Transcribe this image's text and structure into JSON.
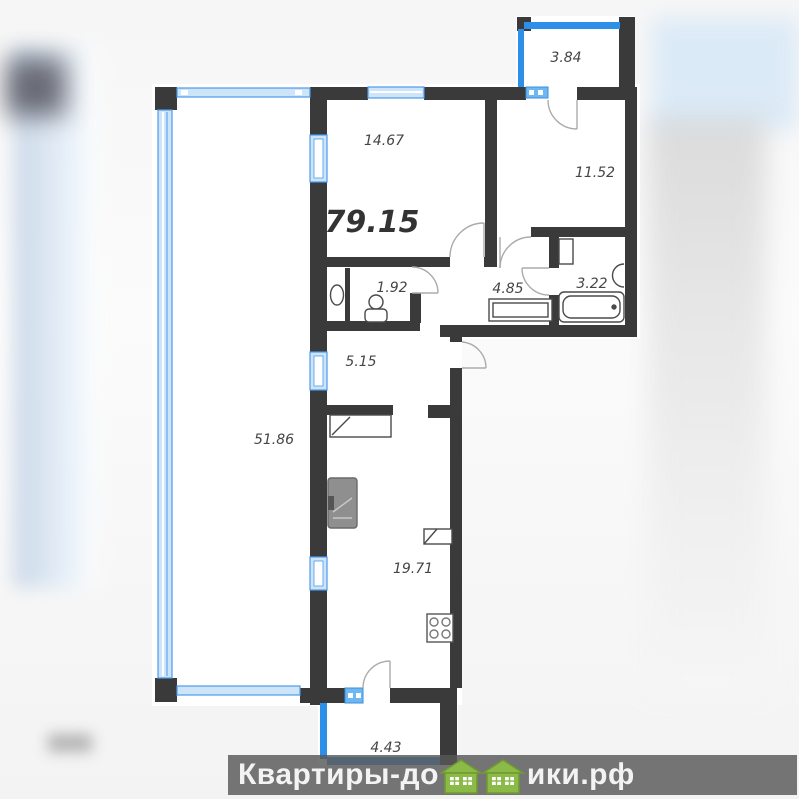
{
  "plan": {
    "total_area_label": "79.15",
    "rooms": [
      {
        "name": "balcony-top",
        "area": "3.84"
      },
      {
        "name": "living-room",
        "area": "14.67"
      },
      {
        "name": "bedroom",
        "area": "11.52"
      },
      {
        "name": "wc",
        "area": "1.92"
      },
      {
        "name": "hallway",
        "area": "4.85"
      },
      {
        "name": "bathroom",
        "area": "3.22"
      },
      {
        "name": "corridor",
        "area": "5.15"
      },
      {
        "name": "terrace",
        "area": "51.86"
      },
      {
        "name": "kitchen-living",
        "area": "19.71"
      },
      {
        "name": "balcony-bottom",
        "area": "4.43"
      }
    ],
    "colors": {
      "wall": "#3a3a3a",
      "glazing_fill": "#cde4f9",
      "glazing_stroke": "#4a9bed",
      "rail_blue": "#2e8fe8",
      "door_arc": "#ababab",
      "label": "#454545"
    }
  },
  "watermark": {
    "text_before": "Квартиры-до",
    "text_after": "ики.рф",
    "logo": "green-houses",
    "bar_color": "rgba(88,88,88,0.82)",
    "text_color": "#f3f3f3",
    "house_green": "#8cba48"
  }
}
